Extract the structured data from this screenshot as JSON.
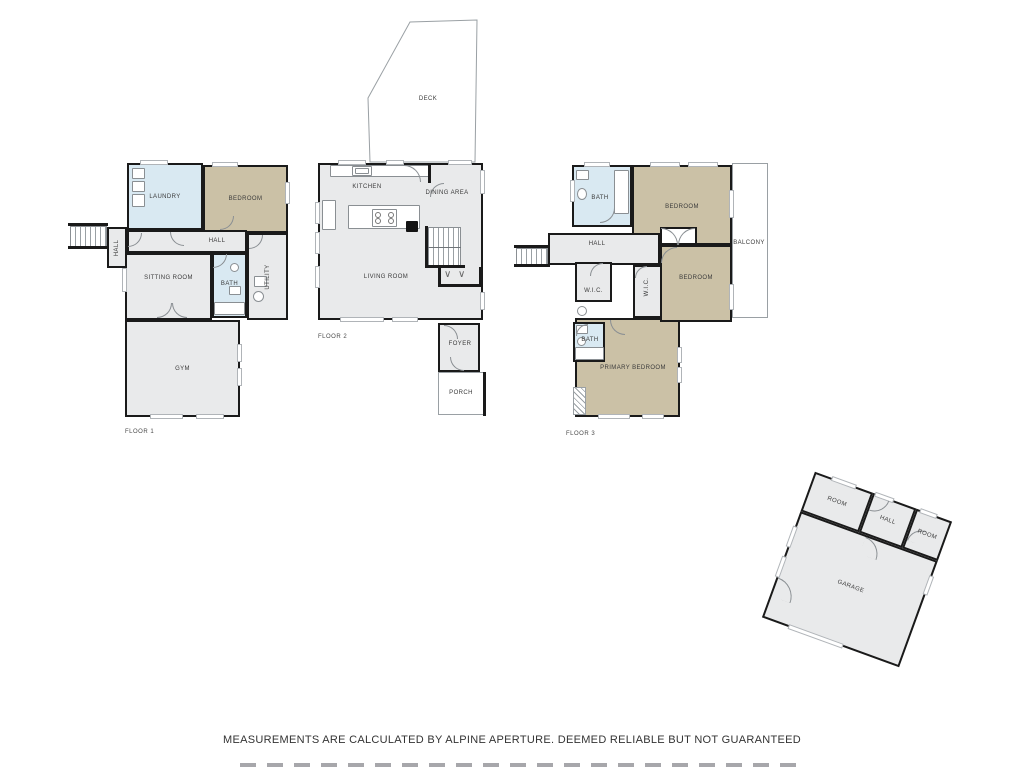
{
  "palette": {
    "wall": "#1a1a1a",
    "gray": "#E9EAEB",
    "blue": "#D9E9F2",
    "tan": "#CBC1A6",
    "white": "#ffffff"
  },
  "footer": {
    "disclaimer": "MEASUREMENTS ARE CALCULATED BY ALPINE APERTURE. DEEMED RELIABLE BUT NOT GUARANTEED"
  },
  "floors": [
    {
      "name": "floor-1",
      "floor_label": "FLOOR 1",
      "floor_label_pos": {
        "x": 125,
        "y": 429
      },
      "frame": {
        "x": 0,
        "y": 0,
        "w": 1024,
        "h": 767,
        "rot": 0
      },
      "rooms": [
        {
          "name": "laundry",
          "label": "LAUNDRY",
          "x": 127,
          "y": 163,
          "w": 76,
          "h": 67,
          "fill": "blue",
          "lx": 165,
          "ly": 197
        },
        {
          "name": "bedroom",
          "label": "BEDROOM",
          "x": 203,
          "y": 165,
          "w": 85,
          "h": 68,
          "fill": "tan"
        },
        {
          "name": "entry-hall",
          "label": "HALL",
          "x": 107,
          "y": 227,
          "w": 20,
          "h": 41,
          "fill": "gray",
          "vert": true
        },
        {
          "name": "hall",
          "label": "HALL",
          "x": 127,
          "y": 230,
          "w": 120,
          "h": 23,
          "fill": "gray",
          "lx": 217,
          "ly": 241
        },
        {
          "name": "sitting-room",
          "label": "SITTING ROOM",
          "x": 125,
          "y": 253,
          "w": 87,
          "h": 67,
          "fill": "gray",
          "ly": 278
        },
        {
          "name": "bath",
          "label": "BATH",
          "x": 212,
          "y": 253,
          "w": 35,
          "h": 65,
          "fill": "blue",
          "ly": 284
        },
        {
          "name": "utility",
          "label": "UTILITY",
          "x": 247,
          "y": 233,
          "w": 41,
          "h": 87,
          "fill": "gray",
          "vert": true
        },
        {
          "name": "gym",
          "label": "GYM",
          "x": 125,
          "y": 320,
          "w": 115,
          "h": 97,
          "fill": "gray"
        }
      ],
      "walls": [
        {
          "x": 68,
          "y": 223,
          "w": 40,
          "h": 3
        },
        {
          "x": 68,
          "y": 246,
          "w": 40,
          "h": 3
        }
      ],
      "stairs": [
        {
          "x": 70,
          "y": 226,
          "w": 37,
          "h": 21,
          "dir": "v"
        }
      ],
      "windows": [
        {
          "x": 140,
          "y": 160,
          "w": 28,
          "h": 5
        },
        {
          "x": 212,
          "y": 162,
          "w": 26,
          "h": 5
        },
        {
          "x": 285,
          "y": 182,
          "w": 5,
          "h": 22
        },
        {
          "x": 122,
          "y": 268,
          "w": 5,
          "h": 24
        },
        {
          "x": 150,
          "y": 414,
          "w": 33,
          "h": 5
        },
        {
          "x": 196,
          "y": 414,
          "w": 28,
          "h": 5
        },
        {
          "x": 237,
          "y": 344,
          "w": 5,
          "h": 18
        },
        {
          "x": 237,
          "y": 368,
          "w": 5,
          "h": 18
        }
      ],
      "doors": [
        {
          "x": 170,
          "y": 232,
          "s": 14,
          "q": "bl"
        },
        {
          "x": 220,
          "y": 216,
          "s": 14,
          "q": "br"
        },
        {
          "x": 249,
          "y": 235,
          "s": 14,
          "q": "br"
        },
        {
          "x": 213,
          "y": 254,
          "s": 14,
          "q": "br"
        },
        {
          "x": 157,
          "y": 303,
          "s": 15,
          "q": "br"
        },
        {
          "x": 172,
          "y": 303,
          "s": 15,
          "q": "bl"
        },
        {
          "x": 128,
          "y": 233,
          "s": 14,
          "q": "br"
        }
      ],
      "fixtures": [
        {
          "t": "rect",
          "n": "cabinet",
          "x": 132,
          "y": 168,
          "w": 13,
          "h": 11
        },
        {
          "t": "rect",
          "n": "washer",
          "x": 132,
          "y": 181,
          "w": 13,
          "h": 11
        },
        {
          "t": "rect",
          "n": "dryer",
          "x": 132,
          "y": 194,
          "w": 13,
          "h": 13
        },
        {
          "t": "circle",
          "n": "sink",
          "x": 230,
          "y": 263,
          "w": 9,
          "h": 9
        },
        {
          "t": "rect",
          "n": "toilet",
          "x": 229,
          "y": 286,
          "w": 12,
          "h": 9
        },
        {
          "t": "rect",
          "n": "tub",
          "x": 214,
          "y": 302,
          "w": 31,
          "h": 13
        },
        {
          "t": "rect",
          "n": "counter",
          "x": 254,
          "y": 276,
          "w": 13,
          "h": 11
        },
        {
          "t": "circle",
          "n": "washer",
          "x": 253,
          "y": 291,
          "w": 11,
          "h": 11
        }
      ],
      "texts": []
    },
    {
      "name": "floor-2",
      "floor_label": "FLOOR 2",
      "floor_label_pos": {
        "x": 318,
        "y": 334
      },
      "frame": {
        "x": 0,
        "y": 0,
        "w": 1024,
        "h": 767,
        "rot": 0
      },
      "polygons": [
        {
          "name": "deck",
          "points": "370,162 368,98 410,22 477,20 475,162",
          "label": "DECK",
          "lx": 428,
          "ly": 99
        }
      ],
      "areas": [
        {
          "name": "porch",
          "label": "PORCH",
          "x": 438,
          "y": 372,
          "w": 48,
          "h": 43,
          "lx": 461,
          "ly": 393
        }
      ],
      "rooms": [
        {
          "name": "main",
          "label": "",
          "x": 318,
          "y": 163,
          "w": 165,
          "h": 157,
          "fill": "gray"
        },
        {
          "name": "foyer",
          "label": "FOYER",
          "x": 438,
          "y": 323,
          "w": 42,
          "h": 49,
          "lx": 460,
          "ly": 344
        }
      ],
      "walls": [
        {
          "x": 428,
          "y": 163,
          "w": 3,
          "h": 20
        },
        {
          "x": 425,
          "y": 226,
          "w": 3,
          "h": 42
        },
        {
          "x": 425,
          "y": 265,
          "w": 40,
          "h": 3
        },
        {
          "x": 438,
          "y": 267,
          "w": 3,
          "h": 20
        },
        {
          "x": 479,
          "y": 267,
          "w": 4,
          "h": 20
        },
        {
          "x": 438,
          "y": 284,
          "w": 45,
          "h": 3
        },
        {
          "x": 483,
          "y": 372,
          "w": 3,
          "h": 44
        }
      ],
      "stairs": [
        {
          "x": 428,
          "y": 227,
          "w": 33,
          "h": 40,
          "dir": "v",
          "divider": true
        }
      ],
      "windows": [
        {
          "x": 338,
          "y": 160,
          "w": 28,
          "h": 5
        },
        {
          "x": 386,
          "y": 160,
          "w": 18,
          "h": 5
        },
        {
          "x": 448,
          "y": 160,
          "w": 24,
          "h": 5
        },
        {
          "x": 315,
          "y": 202,
          "w": 5,
          "h": 22
        },
        {
          "x": 315,
          "y": 232,
          "w": 5,
          "h": 22
        },
        {
          "x": 315,
          "y": 266,
          "w": 5,
          "h": 22
        },
        {
          "x": 340,
          "y": 317,
          "w": 44,
          "h": 5
        },
        {
          "x": 392,
          "y": 317,
          "w": 26,
          "h": 5
        },
        {
          "x": 480,
          "y": 170,
          "w": 5,
          "h": 24
        },
        {
          "x": 480,
          "y": 292,
          "w": 5,
          "h": 18
        }
      ],
      "doors": [
        {
          "x": 404,
          "y": 165,
          "s": 17,
          "q": "tr"
        },
        {
          "x": 430,
          "y": 183,
          "s": 14,
          "q": "tl"
        },
        {
          "x": 444,
          "y": 325,
          "s": 14,
          "q": "tr"
        },
        {
          "x": 450,
          "y": 357,
          "s": 14,
          "q": "bl"
        }
      ],
      "fixtures": [
        {
          "t": "rect",
          "n": "counter",
          "x": 330,
          "y": 165,
          "w": 100,
          "h": 12
        },
        {
          "t": "sink",
          "n": "sink",
          "x": 352,
          "y": 166,
          "w": 20,
          "h": 10
        },
        {
          "t": "rect",
          "n": "counter",
          "x": 322,
          "y": 200,
          "w": 14,
          "h": 30
        },
        {
          "t": "rect",
          "n": "island",
          "x": 348,
          "y": 205,
          "w": 72,
          "h": 24
        },
        {
          "t": "stove",
          "n": "stove",
          "x": 372,
          "y": 209,
          "w": 25,
          "h": 18
        },
        {
          "t": "black",
          "n": "appliance",
          "x": 406,
          "y": 221,
          "w": 12,
          "h": 11
        },
        {
          "t": "chev",
          "x": 444,
          "y": 270,
          "w": 12,
          "h": 12
        },
        {
          "t": "chev",
          "x": 458,
          "y": 270,
          "w": 12,
          "h": 12
        }
      ],
      "texts": [
        {
          "name": "kitchen-label",
          "t": "KITCHEN",
          "x": 367,
          "y": 187
        },
        {
          "name": "dining-area-label",
          "t": "DINING AREA",
          "x": 447,
          "y": 193
        },
        {
          "name": "living-room-label",
          "t": "LIVING ROOM",
          "x": 386,
          "y": 277
        }
      ]
    },
    {
      "name": "floor-3",
      "floor_label": "FLOOR 3",
      "floor_label_pos": {
        "x": 566,
        "y": 431
      },
      "frame": {
        "x": 0,
        "y": 0,
        "w": 1024,
        "h": 767,
        "rot": 0
      },
      "areas": [
        {
          "name": "balcony",
          "label": "BALCONY",
          "x": 732,
          "y": 163,
          "w": 36,
          "h": 155,
          "lx": 749,
          "ly": 243
        }
      ],
      "rooms": [
        {
          "name": "primary-bedroom",
          "label": "PRIMARY BEDROOM",
          "x": 575,
          "y": 318,
          "w": 105,
          "h": 99,
          "fill": "tan",
          "lx": 633,
          "ly": 368
        },
        {
          "name": "bath-top",
          "label": "BATH",
          "x": 572,
          "y": 165,
          "w": 60,
          "h": 62,
          "fill": "blue",
          "lx": 600,
          "ly": 198
        },
        {
          "name": "bedroom-1",
          "label": "BEDROOM",
          "x": 632,
          "y": 165,
          "w": 100,
          "h": 80,
          "fill": "tan",
          "ly": 207
        },
        {
          "name": "hall",
          "label": "HALL",
          "x": 548,
          "y": 233,
          "w": 112,
          "h": 32,
          "fill": "gray",
          "lx": 597,
          "ly": 244
        },
        {
          "name": "closet",
          "label": "",
          "x": 660,
          "y": 227,
          "w": 37,
          "h": 18,
          "fill": "white"
        },
        {
          "name": "wic-left",
          "label": "W.I.C.",
          "x": 575,
          "y": 262,
          "w": 37,
          "h": 40,
          "fill": "gray",
          "ly": 291
        },
        {
          "name": "wic-mid",
          "label": "W.I.C.",
          "x": 633,
          "y": 265,
          "w": 29,
          "h": 53,
          "fill": "gray",
          "vert": true,
          "lx": 647,
          "ly": 287
        },
        {
          "name": "bedroom-2",
          "label": "BEDROOM",
          "x": 660,
          "y": 245,
          "w": 72,
          "h": 77,
          "fill": "tan",
          "ly": 278
        },
        {
          "name": "bath-bottom",
          "label": "BATH",
          "x": 573,
          "y": 322,
          "w": 32,
          "h": 40,
          "fill": "blue",
          "lx": 590,
          "ly": 340
        }
      ],
      "walls": [
        {
          "x": 514,
          "y": 245,
          "w": 36,
          "h": 3
        },
        {
          "x": 514,
          "y": 264,
          "w": 36,
          "h": 3
        }
      ],
      "stairs": [
        {
          "x": 516,
          "y": 248,
          "w": 32,
          "h": 17,
          "dir": "v"
        }
      ],
      "hatch": [
        {
          "x": 573,
          "y": 387,
          "w": 13,
          "h": 28
        }
      ],
      "windows": [
        {
          "x": 584,
          "y": 162,
          "w": 26,
          "h": 5
        },
        {
          "x": 650,
          "y": 162,
          "w": 30,
          "h": 5
        },
        {
          "x": 688,
          "y": 162,
          "w": 30,
          "h": 5
        },
        {
          "x": 570,
          "y": 180,
          "w": 5,
          "h": 22
        },
        {
          "x": 729,
          "y": 190,
          "w": 5,
          "h": 28
        },
        {
          "x": 729,
          "y": 284,
          "w": 5,
          "h": 26
        },
        {
          "x": 677,
          "y": 347,
          "w": 5,
          "h": 16
        },
        {
          "x": 677,
          "y": 367,
          "w": 5,
          "h": 16
        },
        {
          "x": 598,
          "y": 414,
          "w": 32,
          "h": 5
        },
        {
          "x": 642,
          "y": 414,
          "w": 22,
          "h": 5
        }
      ],
      "doors": [
        {
          "x": 600,
          "y": 208,
          "s": 15,
          "q": "br"
        },
        {
          "x": 661,
          "y": 228,
          "s": 17,
          "q": "tr"
        },
        {
          "x": 678,
          "y": 228,
          "s": 17,
          "q": "tl"
        },
        {
          "x": 661,
          "y": 247,
          "s": 16,
          "q": "tl"
        },
        {
          "x": 590,
          "y": 263,
          "s": 13,
          "q": "tl"
        },
        {
          "x": 635,
          "y": 266,
          "s": 12,
          "q": "tl"
        },
        {
          "x": 610,
          "y": 320,
          "s": 15,
          "q": "bl"
        },
        {
          "x": 576,
          "y": 324,
          "s": 12,
          "q": "tl"
        }
      ],
      "fixtures": [
        {
          "t": "rect",
          "n": "vanity",
          "x": 576,
          "y": 170,
          "w": 13,
          "h": 10
        },
        {
          "t": "circle",
          "n": "toilet",
          "x": 577,
          "y": 188,
          "w": 10,
          "h": 12
        },
        {
          "t": "rect",
          "n": "tub",
          "x": 614,
          "y": 170,
          "w": 15,
          "h": 44
        },
        {
          "t": "circle",
          "n": "sink",
          "x": 577,
          "y": 306,
          "w": 10,
          "h": 10
        },
        {
          "t": "rect",
          "n": "toilet",
          "x": 576,
          "y": 325,
          "w": 12,
          "h": 9
        },
        {
          "t": "circle",
          "n": "sink",
          "x": 577,
          "y": 337,
          "w": 9,
          "h": 9
        },
        {
          "t": "rect",
          "n": "tub",
          "x": 575,
          "y": 347,
          "w": 29,
          "h": 13
        }
      ],
      "texts": []
    },
    {
      "name": "garage",
      "frame": {
        "x": 784,
        "y": 492,
        "w": 146,
        "h": 155,
        "rot": 20
      },
      "rooms": [
        {
          "name": "room-left",
          "label": "ROOM",
          "x": 0,
          "y": 0,
          "w": 62,
          "h": 42,
          "fill": "gray"
        },
        {
          "name": "hall",
          "label": "HALL",
          "x": 62,
          "y": 0,
          "w": 46,
          "h": 42,
          "fill": "gray"
        },
        {
          "name": "room-right",
          "label": "ROOM",
          "x": 108,
          "y": 0,
          "w": 38,
          "h": 42,
          "fill": "gray"
        },
        {
          "name": "garage-bay",
          "label": "GARAGE",
          "x": 0,
          "y": 42,
          "w": 146,
          "h": 113,
          "fill": "gray",
          "ly": 96
        }
      ],
      "windows": [
        {
          "x": -2,
          "y": 58,
          "w": 5,
          "h": 22
        },
        {
          "x": -2,
          "y": 90,
          "w": 5,
          "h": 22
        },
        {
          "x": 18,
          "y": -2,
          "w": 26,
          "h": 5
        },
        {
          "x": 64,
          "y": -2,
          "w": 20,
          "h": 5
        },
        {
          "x": 112,
          "y": -2,
          "w": 18,
          "h": 5
        },
        {
          "x": 143,
          "y": 58,
          "w": 5,
          "h": 20
        },
        {
          "x": 28,
          "y": 152,
          "w": 58,
          "h": 5
        }
      ],
      "doors": [
        {
          "x": 70,
          "y": 44,
          "s": 18,
          "q": "tr"
        },
        {
          "x": 64,
          "y": 2,
          "s": 16,
          "q": "br"
        },
        {
          "x": 110,
          "y": 18,
          "s": 15,
          "q": "tl"
        },
        {
          "x": 2,
          "y": 112,
          "s": 20,
          "q": "tr"
        }
      ],
      "texts": []
    }
  ]
}
